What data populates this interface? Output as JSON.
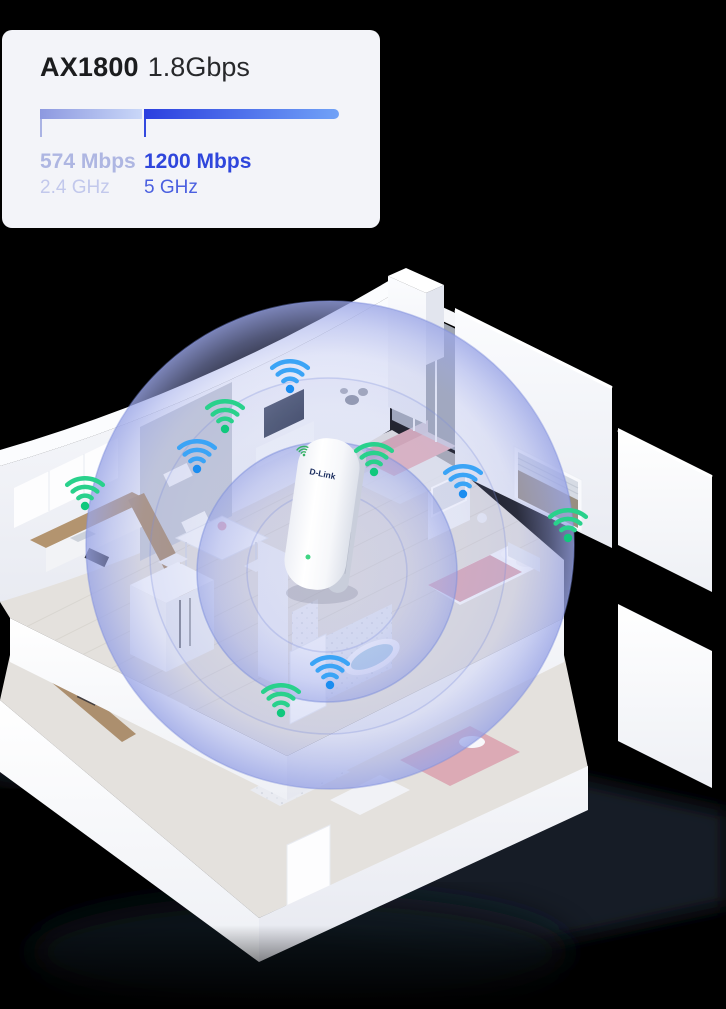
{
  "spec_card": {
    "model": "AX1800",
    "total_speed": "1.8Gbps",
    "bands": [
      {
        "throughput": "574 Mbps",
        "band": "2.4 GHz",
        "text_color": "#aeb6e2",
        "sub_color": "#c2c8ec",
        "bar_gradient": [
          "#8d99e0",
          "#c9d7f8"
        ],
        "bar_width": 102,
        "tick_color": "#aab3e4",
        "tick_left": 38
      },
      {
        "throughput": "1200 Mbps",
        "band": "5 GHz",
        "text_color": "#2f46dc",
        "sub_color": "#4a5fe0",
        "bar_gradient": [
          "#2b3fdf",
          "#71a2f7"
        ],
        "bar_width": 195,
        "tick_color": "#3349df",
        "tick_left": 142
      }
    ]
  },
  "device": {
    "brand": "D-Link",
    "type": "wifi-range-extender",
    "logo_icon": "wifi-signal-icon",
    "led_color": "#3fd584",
    "logo_green": "#33b163"
  },
  "coverage": {
    "color": "#9aa5e6",
    "rim_color": "#7e8fdc"
  },
  "marker_colors": {
    "green": {
      "arc": "#29d18c",
      "dot": "#10c87d"
    },
    "blue": {
      "arc": "#3ba4f6",
      "dot": "#1b8df0"
    }
  },
  "wifi_markers": [
    {
      "band_color": "green",
      "x": 225,
      "y": 429
    },
    {
      "band_color": "blue",
      "x": 290,
      "y": 389
    },
    {
      "band_color": "blue",
      "x": 197,
      "y": 469
    },
    {
      "band_color": "green",
      "x": 85,
      "y": 506
    },
    {
      "band_color": "green",
      "x": 374,
      "y": 472
    },
    {
      "band_color": "blue",
      "x": 463,
      "y": 494
    },
    {
      "band_color": "green",
      "x": 568,
      "y": 538
    },
    {
      "band_color": "blue",
      "x": 330,
      "y": 685
    },
    {
      "band_color": "green",
      "x": 281,
      "y": 713
    }
  ]
}
